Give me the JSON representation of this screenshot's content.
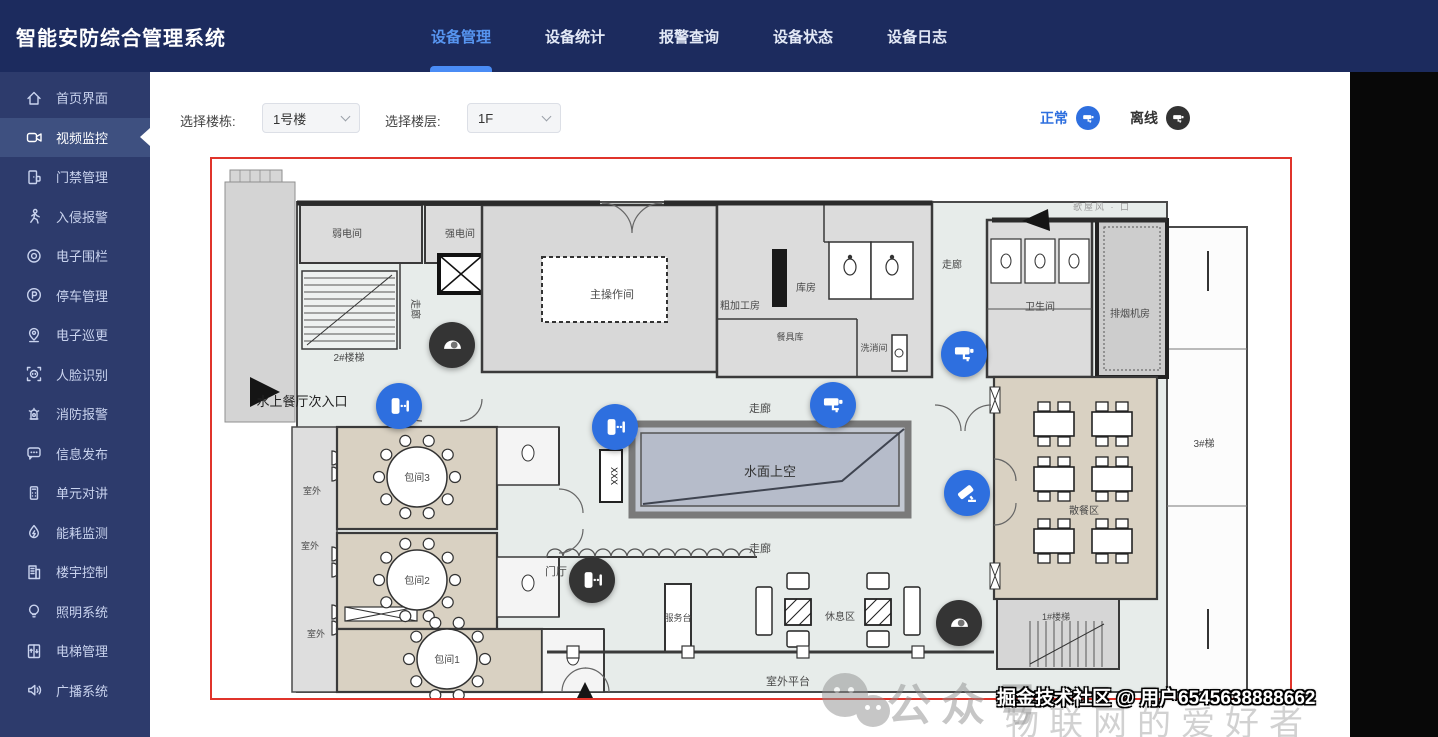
{
  "header": {
    "title": "智能安防综合管理系统",
    "tabs": [
      {
        "label": "设备管理",
        "active": true
      },
      {
        "label": "设备统计",
        "active": false
      },
      {
        "label": "报警查询",
        "active": false
      },
      {
        "label": "设备状态",
        "active": false
      },
      {
        "label": "设备日志",
        "active": false
      }
    ]
  },
  "sidebar": {
    "items": [
      {
        "icon": "home-icon",
        "label": "首页界面",
        "active": false
      },
      {
        "icon": "video-monitor-icon",
        "label": "视频监控",
        "active": true
      },
      {
        "icon": "access-control-icon",
        "label": "门禁管理",
        "active": false
      },
      {
        "icon": "intrusion-alarm-icon",
        "label": "入侵报警",
        "active": false
      },
      {
        "icon": "electronic-fence-icon",
        "label": "电子围栏",
        "active": false
      },
      {
        "icon": "parking-icon",
        "label": "停车管理",
        "active": false
      },
      {
        "icon": "patrol-icon",
        "label": "电子巡更",
        "active": false
      },
      {
        "icon": "face-recognition-icon",
        "label": "人脸识别",
        "active": false
      },
      {
        "icon": "fire-alarm-icon",
        "label": "消防报警",
        "active": false
      },
      {
        "icon": "info-publish-icon",
        "label": "信息发布",
        "active": false
      },
      {
        "icon": "intercom-icon",
        "label": "单元对讲",
        "active": false
      },
      {
        "icon": "energy-monitor-icon",
        "label": "能耗监测",
        "active": false
      },
      {
        "icon": "building-control-icon",
        "label": "楼宇控制",
        "active": false
      },
      {
        "icon": "lighting-icon",
        "label": "照明系统",
        "active": false
      },
      {
        "icon": "elevator-icon",
        "label": "电梯管理",
        "active": false
      },
      {
        "icon": "broadcast-icon",
        "label": "广播系统",
        "active": false
      }
    ]
  },
  "filters": {
    "building_label": "选择楼栋:",
    "building_value": "1号楼",
    "floor_label": "选择楼层:",
    "floor_value": "1F"
  },
  "legend": {
    "normal_label": "正常",
    "offline_label": "离线",
    "normal_color": "#2e6fdf",
    "offline_color": "#3a3a3a"
  },
  "floorplan": {
    "border_color": "#e0342b",
    "labels": [
      {
        "text": "弱电间"
      },
      {
        "text": "强电间"
      },
      {
        "text": "2#楼梯"
      },
      {
        "text": "走廊"
      },
      {
        "text": "主操作间"
      },
      {
        "text": "粗加工房"
      },
      {
        "text": "库房"
      },
      {
        "text": "餐具库"
      },
      {
        "text": "洗消间"
      },
      {
        "text": "走廊"
      },
      {
        "text": "卫生间"
      },
      {
        "text": "排烟机房"
      },
      {
        "text": "水上餐厅次入口"
      },
      {
        "text": "走廊"
      },
      {
        "text": "水面上空"
      },
      {
        "text": "走廊"
      },
      {
        "text": "门厅"
      },
      {
        "text": "包间3"
      },
      {
        "text": "包间2"
      },
      {
        "text": "包间1"
      },
      {
        "text": "室外"
      },
      {
        "text": "室外"
      },
      {
        "text": "室外"
      },
      {
        "text": "服务台"
      },
      {
        "text": "休息区"
      },
      {
        "text": "室外平台"
      },
      {
        "text": "散餐区"
      },
      {
        "text": "3#梯"
      },
      {
        "text": "1#楼梯"
      },
      {
        "text": "XXX"
      },
      {
        "text": "歌屋风 · 口"
      }
    ],
    "devices": [
      {
        "type": "dome-camera",
        "status": "offline"
      },
      {
        "type": "bullet-camera",
        "status": "normal"
      },
      {
        "type": "bullet-camera",
        "status": "normal"
      },
      {
        "type": "box-camera",
        "status": "normal"
      },
      {
        "type": "box-camera",
        "status": "normal"
      },
      {
        "type": "ptz-camera",
        "status": "normal"
      },
      {
        "type": "bullet-camera",
        "status": "offline"
      },
      {
        "type": "dome-camera",
        "status": "offline"
      }
    ]
  },
  "watermarks": {
    "wechat_label": "公众号",
    "wechat_sub": "物联网的爱好者",
    "credit": "掘金技术社区 @ 用户6545638888662"
  }
}
